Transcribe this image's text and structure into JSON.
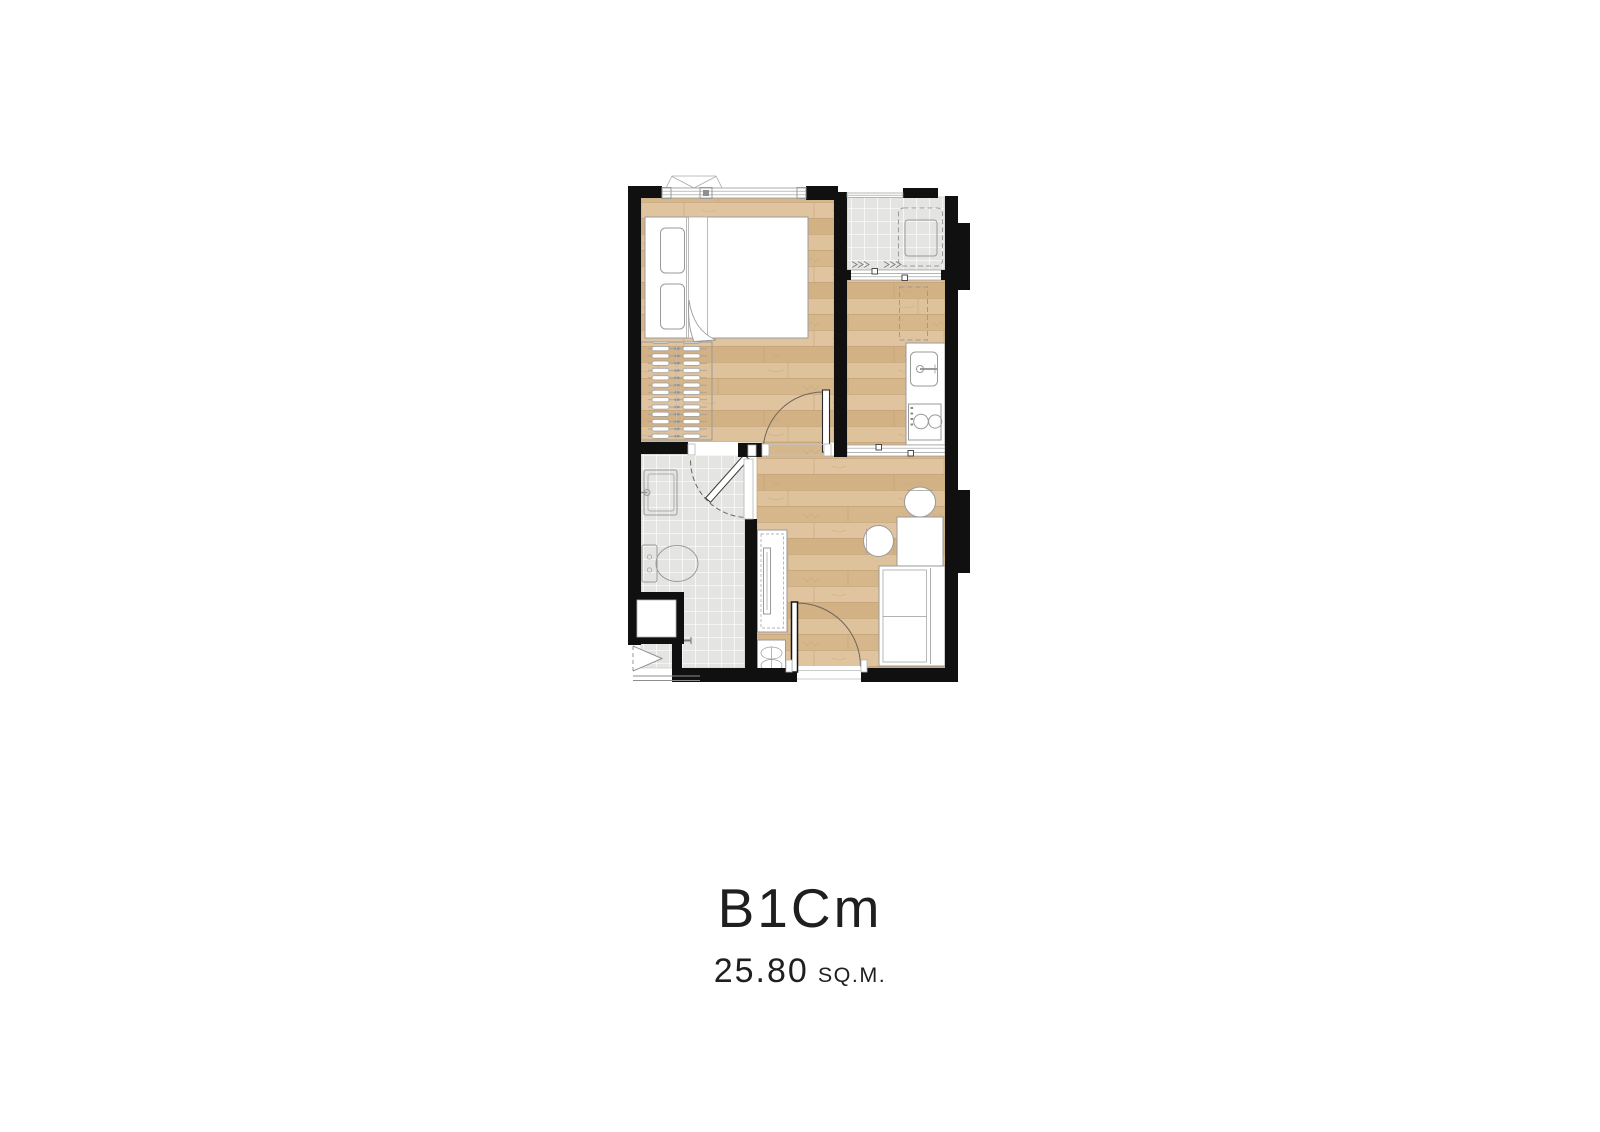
{
  "figure": {
    "title": "B1Cm",
    "area_value": "25.80",
    "area_unit": "SQ.M."
  },
  "colors": {
    "wall": "#101010",
    "wood_mid": "#d8ba8f",
    "wood_r1": "#dec29b",
    "wood_r2": "#d6b78b",
    "wood_r3": "#e0c49f",
    "wood_r4": "#d2b185",
    "wood_line": "#bb9a6e",
    "tile": "#e4e4e2",
    "tile_line": "#ffffff",
    "fixture_stroke": "#9a9a9a",
    "door_arc": "#6f665a",
    "text": "#1f1f1f"
  }
}
